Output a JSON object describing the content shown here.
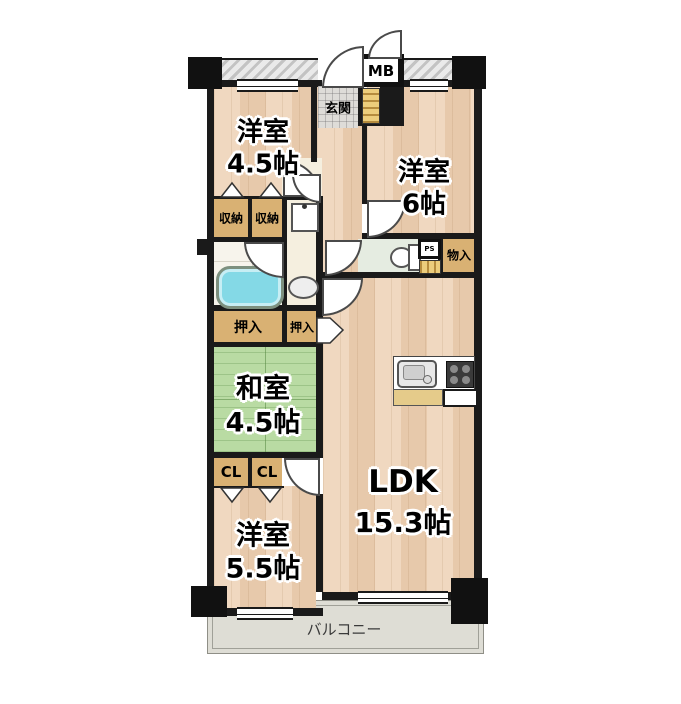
{
  "plan_title": "apartment-floor-plan",
  "rooms": {
    "western1": {
      "label": "洋室",
      "size": "4.5帖"
    },
    "western2": {
      "label": "洋室",
      "size": "6帖"
    },
    "japanese": {
      "label": "和室",
      "size": "4.5帖"
    },
    "western3": {
      "label": "洋室",
      "size": "5.5帖"
    },
    "ldk": {
      "label": "LDK",
      "size": "15.3帖"
    },
    "entrance": {
      "label": "玄関"
    },
    "balcony": {
      "label": "バルコニー"
    }
  },
  "storage": {
    "shunou": "収納",
    "oshiire": "押入",
    "closet": "CL",
    "monoire": "物入"
  },
  "utility": {
    "meter_box": "MB",
    "pipe_space": "PS"
  },
  "colors": {
    "wall": "#1a1a1a",
    "wood": "#ecd2b8",
    "tatami": "#b9dba3",
    "closet": "#d9b173",
    "cream": "#f5efdf",
    "bathFloor": "#f7f4ec",
    "toiletFloor": "#e5ece1",
    "tile": "#dedcd8",
    "stripe": "#eccd7c",
    "balcony": "#deddd5",
    "tub": "#84d9e6"
  }
}
